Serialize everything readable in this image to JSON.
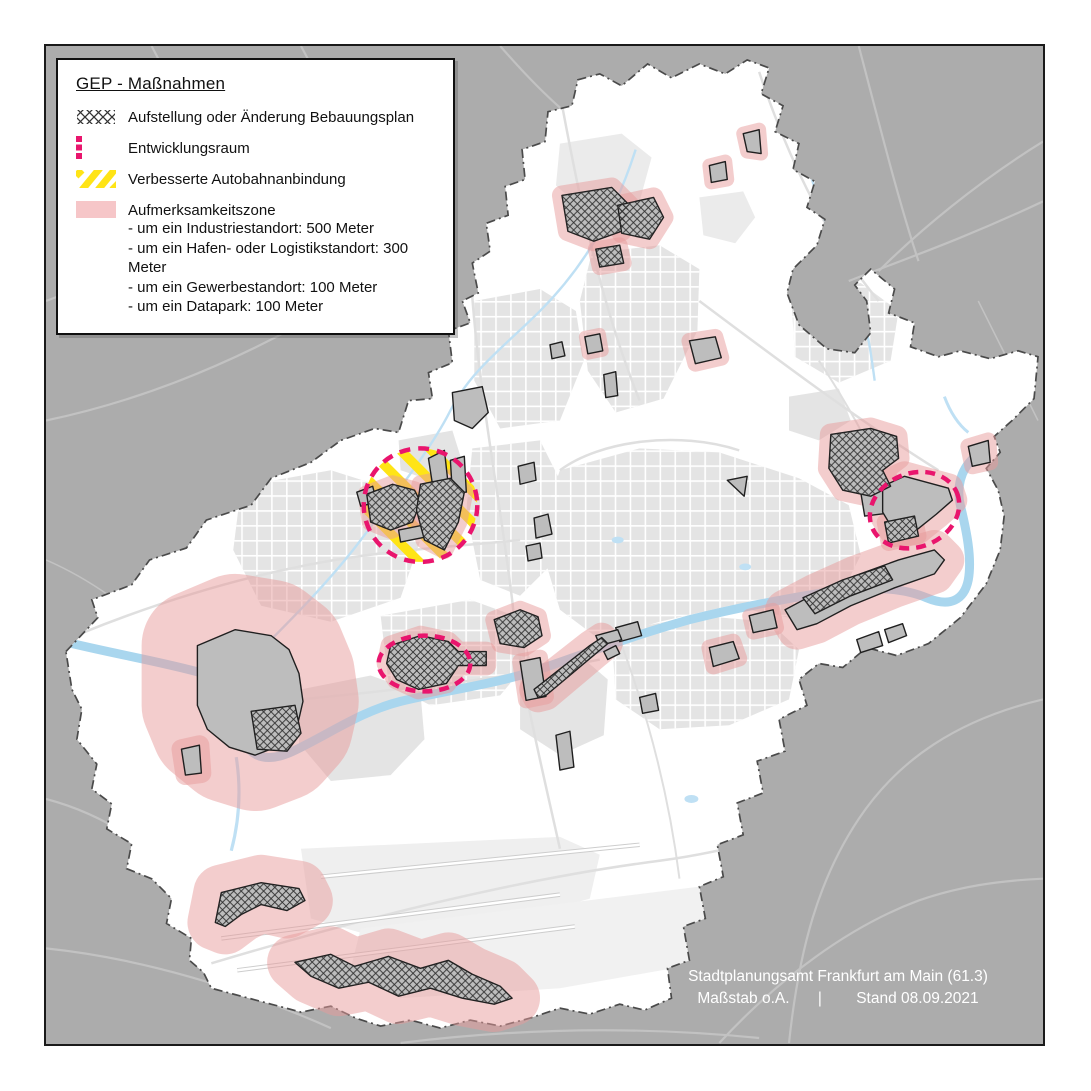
{
  "legend": {
    "title": "GEP - Maßnahmen",
    "items": [
      {
        "label": "Aufstellung oder Änderung Bebauungsplan",
        "icon": "crosshatch-swatch-icon"
      },
      {
        "label": "Entwicklungsraum",
        "icon": "dashed-pink-rect-icon"
      },
      {
        "label": "Verbesserte Autobahnanbindung",
        "icon": "yellow-stripes-icon"
      },
      {
        "label": "Aufmerksamkeitszone",
        "icon": "pink-area-icon",
        "details": [
          "- um ein Industriestandort: 500 Meter",
          "- um ein Hafen- oder Logistikstandort: 300 Meter",
          "- um ein Gewerbestandort: 100 Meter",
          "- um ein Datapark: 100 Meter"
        ]
      }
    ]
  },
  "attribution": {
    "line1": "Stadtplanungsamt Frankfurt am Main (61.3)",
    "scale": "Maßstab o.A.",
    "separator": "|",
    "date": "Stand 08.09.2021"
  },
  "colors": {
    "outside_gray": "#ACACAC",
    "city_white": "#FFFFFF",
    "urban_gray": "#E4E4E4",
    "river_blue": "#A9D6EE",
    "stream_blue": "#BFE0F4",
    "site_gray": "#BDBDBD",
    "site_outline": "#1F1F1F",
    "attention_pink": "#E89C9C",
    "development_pink": "#E9156D",
    "autobahn_yellow": "#FFE416",
    "boundary_gray": "#4A4A4A"
  }
}
